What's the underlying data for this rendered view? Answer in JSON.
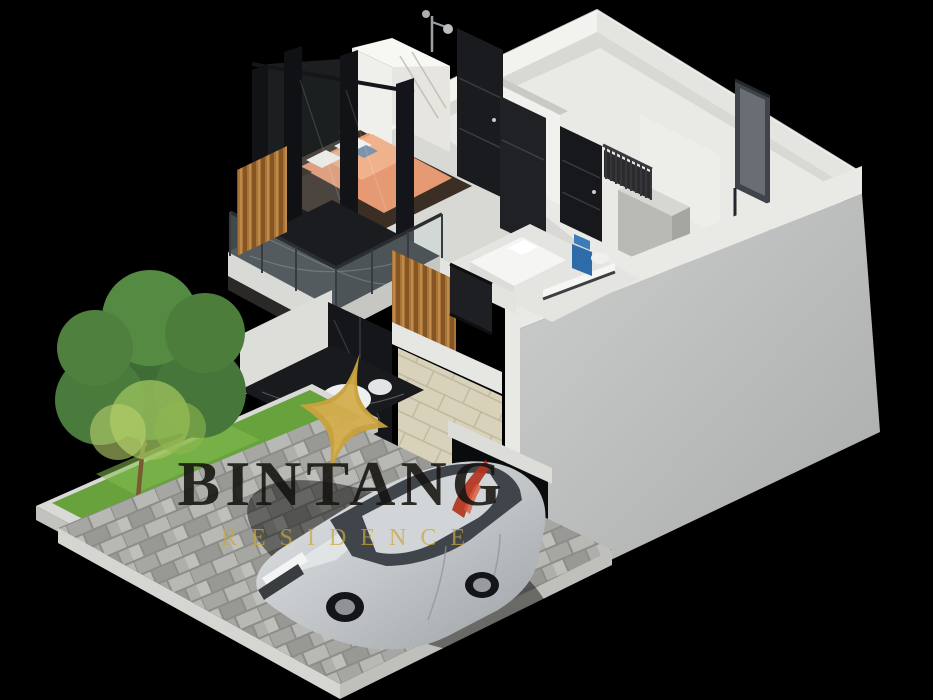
{
  "watermark": {
    "brand": "BINTANG",
    "subtitle": "RESIDENCE",
    "logo_name": "gold-star-logo",
    "colors": {
      "brand_text": "#141210",
      "subtitle_text": "#cba63e",
      "logo_gold": "#c9a23c",
      "accent_red": "#b5341f"
    }
  },
  "scene": {
    "type": "isometric-3d-cutaway-architectural-render",
    "background_color": "#000000",
    "house": {
      "floors": 2,
      "upper_floor": [
        "master bedroom with orange bedding and gold sphere lamp",
        "balcony with glass railing and black marble floor",
        "wood slat accent wall",
        "bathroom with chrome shower",
        "white marble wardrobe",
        "dark panel doors",
        "staircase with black baluster railing",
        "gray utility box",
        "freestanding dark-framed door on right parapet",
        "small plant in wall niche"
      ],
      "ground_floor": [
        "bedroom with white bed, desk shelf and blue accent chair",
        "cream brick facade panel",
        "wood slat window band",
        "black framed glass windows",
        "black marble entry floor with round white table and chairs",
        "garage opening with parked car",
        "large blank gray side wall"
      ]
    },
    "yard": {
      "tree": "single green leafy tree",
      "lawn": "grass planter strip with white concrete curb",
      "driveway": "gray interlocking paver driveway platform",
      "vehicle": "silver compact SUV parked facing front-left"
    },
    "palette": {
      "wall_white": "#eceae6",
      "wall_gray": "#c3c5c4",
      "brick_cream": "#d9d2ba",
      "wood_slat": "#a9743a",
      "marble_black": "#1b1c1f",
      "bed_orange": "#e69a74",
      "grass_green": "#67a23c",
      "paver_gray": "#a0a09c",
      "car_silver": "#ccd0d3",
      "chair_blue": "#2d6ca8"
    }
  }
}
